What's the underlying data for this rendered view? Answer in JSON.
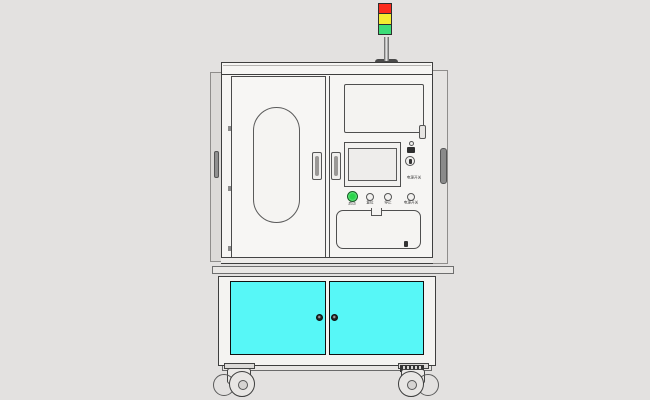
{
  "page": {
    "background": "#e3e1e0"
  },
  "machine": {
    "title": "industrial-equipment-front-view",
    "signal_tower": {
      "red": "#fb2b1d",
      "yellow": "#f5ec30",
      "green": "#3cdd78"
    },
    "panel": {
      "power_switch_label": "电源开关",
      "buttons": [
        {
          "label": "启动",
          "color": "#29d44a",
          "lit": true
        },
        {
          "label": "复位",
          "lit": false
        },
        {
          "label": "停止",
          "lit": false
        },
        {
          "label": "电源开关",
          "lit": false
        }
      ]
    },
    "lower_cabinet": {
      "door_color": "#57f7f7"
    },
    "icons": {
      "tower_red": "tower-light-red",
      "tower_yellow": "tower-light-yellow",
      "tower_green": "tower-light-green",
      "door_knob": "round-knob",
      "key_switch": "key-switch",
      "caster": "swivel-caster-wheel"
    }
  }
}
